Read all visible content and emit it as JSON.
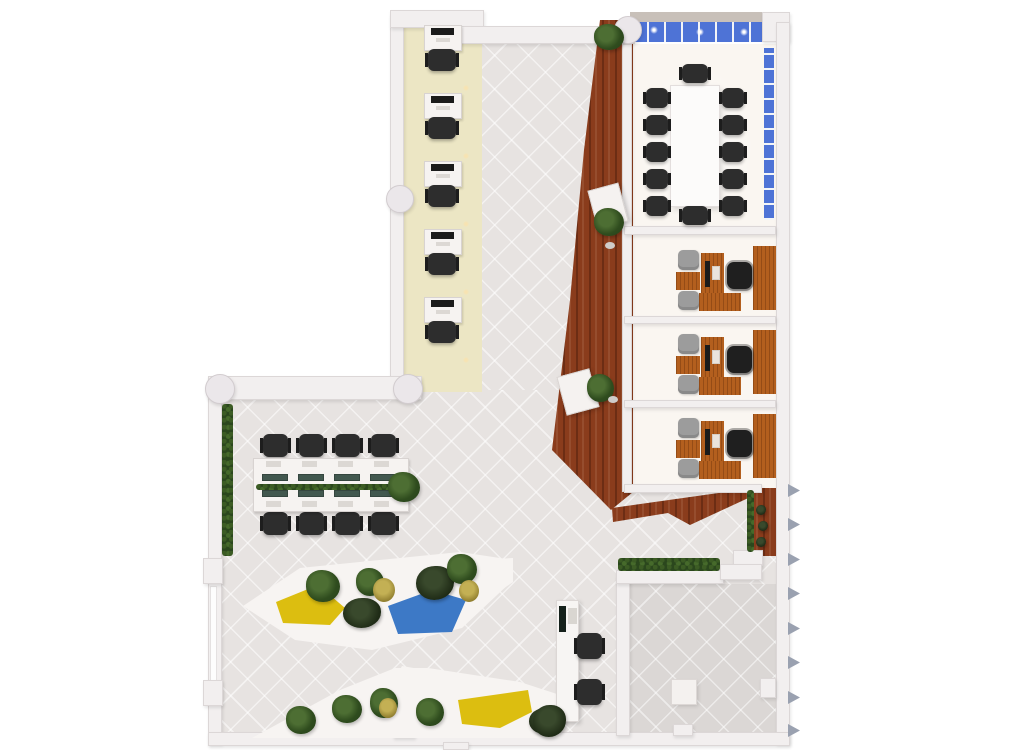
{
  "canvas": {
    "w": 1024,
    "h": 750,
    "background": "#ffffff"
  },
  "palette": {
    "floor_tile": "#e7e3e1",
    "patio_tile": "#dbd7d5",
    "cream_strip": "#ece6c4",
    "room_floor": "#faf6f1",
    "walkway_wood": "#8a3c1c",
    "desk_wood": "#b35f1e",
    "window_blue": "#4e73d6",
    "wall": "#f2efef",
    "facade_band": "#c8c0b9",
    "hedge_green": "#2b471d",
    "seat_yellow": "#dcbe10",
    "seat_blue": "#3d79c6",
    "chair_black": "#2d2d2d",
    "chair_gray": "#9c9c9c",
    "monitor_teal": "#42584f"
  },
  "scene": {
    "base": [
      {
        "n": "floor-open-area",
        "t": "tile",
        "x": 210,
        "y": 376,
        "w": 580,
        "h": 368
      },
      {
        "n": "floor-upper-hall",
        "t": "tile",
        "x": 455,
        "y": 26,
        "w": 180,
        "h": 364
      },
      {
        "n": "floor-corridor-cream",
        "t": "cream",
        "x": 404,
        "y": 14,
        "w": 78,
        "h": 378
      },
      {
        "n": "floor-rooms",
        "t": "room",
        "x": 630,
        "y": 44,
        "w": 146,
        "h": 446
      },
      {
        "n": "floor-patio",
        "t": "tileD",
        "x": 628,
        "y": 584,
        "w": 148,
        "h": 150
      },
      {
        "n": "wood-walkway",
        "t": "wood",
        "x": 550,
        "y": 18,
        "w": 86,
        "h": 494,
        "clip": "50px 2px,83px 2px,83px 474px,61px 492px,2px 432px,20px 282px,34px 132px"
      },
      {
        "n": "wood-chevron-bench",
        "t": "wood",
        "x": 610,
        "y": 486,
        "w": 150,
        "h": 40,
        "clip": "2px 22px,137px 3px,147px 8px,80px 39px,58px 27px,3px 36px"
      },
      {
        "n": "wood-strip-right",
        "t": "wood",
        "x": 750,
        "y": 488,
        "w": 28,
        "h": 68
      },
      {
        "n": "conference-floor-glow",
        "t": "glow",
        "x": 640,
        "y": 66,
        "w": 112,
        "h": 160
      },
      {
        "n": "wall-corridor-left",
        "t": "wall",
        "x": 390,
        "y": 14,
        "w": 14,
        "h": 380
      },
      {
        "n": "wall-corridor-cap",
        "t": "wall",
        "x": 390,
        "y": 10,
        "w": 94,
        "h": 18
      },
      {
        "n": "wall-top-mid",
        "t": "wall",
        "x": 455,
        "y": 26,
        "w": 178,
        "h": 18
      },
      {
        "n": "facade-band-top",
        "t": "beige",
        "x": 630,
        "y": 12,
        "w": 158,
        "h": 12
      },
      {
        "n": "window-band-top",
        "t": "winH",
        "x": 630,
        "y": 22,
        "w": 134,
        "h": 20
      },
      {
        "n": "wall-corner-topright",
        "t": "wall",
        "x": 762,
        "y": 12,
        "w": 28,
        "h": 30
      },
      {
        "n": "wall-right",
        "t": "wall",
        "x": 776,
        "y": 22,
        "w": 14,
        "h": 722
      },
      {
        "n": "window-band-right",
        "t": "winV",
        "x": 764,
        "y": 48,
        "w": 10,
        "h": 172
      },
      {
        "n": "wall-rooms-left",
        "t": "wall",
        "x": 622,
        "y": 44,
        "w": 10,
        "h": 448
      },
      {
        "n": "wall-conference-bottom",
        "t": "wall",
        "x": 624,
        "y": 226,
        "w": 152,
        "h": 9
      },
      {
        "n": "wall-office-divider-1",
        "t": "wall",
        "x": 624,
        "y": 316,
        "w": 152,
        "h": 8
      },
      {
        "n": "wall-office-divider-2",
        "t": "wall",
        "x": 624,
        "y": 400,
        "w": 152,
        "h": 8
      },
      {
        "n": "wall-offices-bottom",
        "t": "wall",
        "x": 624,
        "y": 484,
        "w": 138,
        "h": 9
      },
      {
        "n": "wall-mid-horizontal",
        "t": "wall",
        "x": 208,
        "y": 376,
        "w": 214,
        "h": 24
      },
      {
        "n": "wall-left",
        "t": "wall",
        "x": 208,
        "y": 376,
        "w": 14,
        "h": 368
      },
      {
        "n": "glazing-left-wall",
        "t": "glz",
        "x": 210,
        "y": 586,
        "w": 7,
        "h": 98
      },
      {
        "n": "wall-bottom",
        "t": "wall",
        "x": 208,
        "y": 732,
        "w": 582,
        "h": 14
      },
      {
        "n": "ledge-wood-strip",
        "t": "wall",
        "x": 733,
        "y": 550,
        "w": 30,
        "h": 16
      },
      {
        "n": "wall-patio-left",
        "t": "wall",
        "x": 616,
        "y": 576,
        "w": 14,
        "h": 160
      },
      {
        "n": "wall-patio-top",
        "t": "wall",
        "x": 616,
        "y": 570,
        "w": 108,
        "h": 14
      },
      {
        "n": "wall-patio-ledge",
        "t": "wall",
        "x": 720,
        "y": 564,
        "w": 42,
        "h": 16
      },
      {
        "n": "column-left-wall-1",
        "t": "wall",
        "x": 203,
        "y": 558,
        "w": 20,
        "h": 26
      },
      {
        "n": "column-left-wall-2",
        "t": "wall",
        "x": 203,
        "y": 680,
        "w": 20,
        "h": 26
      },
      {
        "n": "stub-bottom-wall",
        "t": "wall",
        "x": 393,
        "y": 726,
        "w": 22,
        "h": 12
      },
      {
        "n": "stub-bottom-exterior",
        "t": "wall",
        "x": 443,
        "y": 742,
        "w": 26,
        "h": 8
      },
      {
        "n": "stub-patio-bottom",
        "t": "wall",
        "x": 673,
        "y": 724,
        "w": 20,
        "h": 12
      },
      {
        "n": "stub-patio-right",
        "t": "wall",
        "x": 760,
        "y": 678,
        "w": 16,
        "h": 20
      },
      {
        "n": "column-round-corridor",
        "t": "colR",
        "x": 386,
        "y": 185,
        "w": 28,
        "h": 28
      },
      {
        "n": "column-round-midwall-left",
        "t": "colR",
        "x": 205,
        "y": 374,
        "w": 30,
        "h": 30
      },
      {
        "n": "column-round-midwall-right",
        "t": "colR",
        "x": 393,
        "y": 374,
        "w": 30,
        "h": 30
      },
      {
        "n": "column-round-top",
        "t": "colR",
        "x": 614,
        "y": 16,
        "w": 28,
        "h": 28
      },
      {
        "n": "window-light-1",
        "t": "dot",
        "x": 650,
        "y": 26,
        "w": 8,
        "h": 8
      },
      {
        "n": "window-light-2",
        "t": "dot",
        "x": 696,
        "y": 28,
        "w": 8,
        "h": 8
      },
      {
        "n": "window-light-3",
        "t": "dot",
        "x": 740,
        "y": 28,
        "w": 8,
        "h": 8
      }
    ],
    "corridor_workstations": {
      "ys": [
        25,
        93,
        161,
        229,
        297
      ],
      "desk": {
        "x": 424,
        "w": 38,
        "h": 26
      },
      "monitor": {
        "dx": 7,
        "dy": 3,
        "w": 23,
        "h": 7
      },
      "keyboard": {
        "dx": 12,
        "dy": 13,
        "w": 14,
        "h": 4
      },
      "chair": {
        "x": 428,
        "dy": 24,
        "w": 28,
        "h": 22
      },
      "light": {
        "x": 463,
        "dy": 60,
        "s": 6
      }
    },
    "conference": {
      "table": {
        "x": 671,
        "y": 86,
        "w": 48,
        "h": 120
      },
      "side_chair_ys": [
        88,
        115,
        142,
        169,
        196
      ],
      "left_x": 646,
      "right_x": 722,
      "chair_w": 22,
      "chair_h": 20,
      "top_chair": {
        "x": 682,
        "y": 64,
        "w": 26,
        "h": 19
      },
      "bottom_chair": {
        "x": 682,
        "y": 206,
        "w": 26,
        "h": 19
      }
    },
    "offices": {
      "tops": [
        240,
        324,
        408
      ],
      "parts": [
        {
          "n": "office-credenza",
          "t": "woodD",
          "dx": 753,
          "dy": 6,
          "w": 23,
          "h": 64
        },
        {
          "n": "guest-chair",
          "t": "chairG",
          "dx": 678,
          "dy": 10,
          "w": 21,
          "h": 20
        },
        {
          "n": "coffee-table",
          "t": "woodD",
          "dx": 676,
          "dy": 32,
          "w": 24,
          "h": 18
        },
        {
          "n": "guest-chair",
          "t": "chairG",
          "dx": 678,
          "dy": 51,
          "w": 21,
          "h": 19
        },
        {
          "n": "office-desk",
          "t": "woodD",
          "dx": 701,
          "dy": 13,
          "w": 23,
          "h": 58
        },
        {
          "n": "office-desk-return",
          "t": "woodD",
          "dx": 699,
          "dy": 53,
          "w": 42,
          "h": 18
        },
        {
          "n": "desk-monitor",
          "t": "monD",
          "dx": 705,
          "dy": 21,
          "w": 5,
          "h": 26
        },
        {
          "n": "desk-keyboard",
          "t": "key",
          "dx": 712,
          "dy": 26,
          "w": 8,
          "h": 14
        },
        {
          "n": "exec-chair",
          "t": "chairE",
          "dx": 727,
          "dy": 22,
          "w": 25,
          "h": 27
        }
      ]
    },
    "bench": {
      "desk": {
        "x": 253,
        "y": 458,
        "w": 156,
        "h": 54
      },
      "monitor_xs": [
        262,
        298,
        334,
        370
      ],
      "monitor_rows": [
        474,
        490
      ],
      "monitor": {
        "w": 26,
        "h": 7
      },
      "chair_xs": [
        263,
        299,
        335,
        371
      ],
      "chair_rows": [
        434,
        512
      ],
      "chair": {
        "w": 25,
        "h": 23
      },
      "paper_xs": [
        266,
        302,
        338,
        374
      ],
      "paper_rows": [
        461,
        501
      ],
      "paper": {
        "w": 15,
        "h": 6
      },
      "divider": {
        "x": 256,
        "y": 484,
        "w": 136,
        "h": 6
      },
      "end_plant": {
        "x": 388,
        "y": 472,
        "w": 32,
        "h": 30
      }
    },
    "fins": {
      "x": 788,
      "w": 12,
      "h": 13,
      "ys": [
        484,
        518,
        553,
        587,
        622,
        656,
        691,
        724
      ]
    },
    "post": [
      {
        "n": "walkway-plant-top",
        "t": "plant",
        "x": 594,
        "y": 24,
        "w": 30,
        "h": 26
      },
      {
        "n": "lectern-upper",
        "t": "lect",
        "x": 592,
        "y": 186,
        "w": 32,
        "h": 40,
        "r": -15
      },
      {
        "n": "lectern-upper-plant",
        "t": "plant",
        "x": 594,
        "y": 208,
        "w": 30,
        "h": 28
      },
      {
        "n": "lectern-upper-stool",
        "t": "pebble",
        "x": 605,
        "y": 242,
        "w": 10,
        "h": 7
      },
      {
        "n": "lectern-lower",
        "t": "lect",
        "x": 561,
        "y": 372,
        "w": 34,
        "h": 40,
        "r": -15
      },
      {
        "n": "lectern-lower-plant",
        "t": "plant",
        "x": 587,
        "y": 374,
        "w": 27,
        "h": 28
      },
      {
        "n": "lectern-lower-stool",
        "t": "pebble",
        "x": 608,
        "y": 396,
        "w": 10,
        "h": 7
      },
      {
        "n": "hedge-left-wall",
        "t": "hedge",
        "x": 222,
        "y": 404,
        "w": 11,
        "h": 152
      },
      {
        "n": "hedge-wood-strip",
        "t": "hedge",
        "x": 747,
        "y": 490,
        "w": 7,
        "h": 62
      },
      {
        "n": "planter-pot-1",
        "t": "plantD",
        "x": 756,
        "y": 505,
        "w": 10,
        "h": 10
      },
      {
        "n": "planter-pot-2",
        "t": "plantD",
        "x": 758,
        "y": 521,
        "w": 10,
        "h": 10
      },
      {
        "n": "planter-pot-3",
        "t": "plantD",
        "x": 756,
        "y": 537,
        "w": 10,
        "h": 10
      },
      {
        "n": "hedge-patio-top",
        "t": "hedge",
        "x": 618,
        "y": 558,
        "w": 102,
        "h": 13
      },
      {
        "n": "lounge1-base",
        "t": "poly",
        "x": 240,
        "y": 552,
        "w": 275,
        "h": 100,
        "clip": "3px 54px,60px 16px,220px 0px,273px 8px,273px 28px,222px 76px,132px 98px,55px 88px"
      },
      {
        "n": "lounge1-wedge-mid",
        "t": "poly",
        "x": 352,
        "y": 576,
        "w": 46,
        "h": 36,
        "clip": "3px 24px,26px 2px,44px 6px,36px 34px,10px 36px"
      },
      {
        "n": "lounge1-wedge-right",
        "t": "poly",
        "x": 455,
        "y": 552,
        "w": 60,
        "h": 60,
        "clip": "3px 48px,25px 8px,58px 6px,58px 30px,15px 60px"
      },
      {
        "n": "lounge1-seat-yellow",
        "t": "seatY",
        "x": 270,
        "y": 585,
        "w": 80,
        "h": 42,
        "clip": "6px 17px,48px 0px,75px 23px,60px 40px,13px 38px"
      },
      {
        "n": "lounge1-seat-blue",
        "t": "seatB",
        "x": 380,
        "y": 590,
        "w": 88,
        "h": 46,
        "clip": "8px 16px,52px 0px,86px 10px,72px 42px,18px 44px"
      },
      {
        "n": "lounge1-plant-1",
        "t": "plant",
        "x": 306,
        "y": 570,
        "w": 34,
        "h": 32
      },
      {
        "n": "lounge1-plant-2",
        "t": "plantD",
        "x": 343,
        "y": 598,
        "w": 38,
        "h": 30
      },
      {
        "n": "lounge1-plant-3",
        "t": "plant",
        "x": 356,
        "y": 568,
        "w": 28,
        "h": 28
      },
      {
        "n": "lounge1-plant-4",
        "t": "plantG",
        "x": 373,
        "y": 578,
        "w": 22,
        "h": 24
      },
      {
        "n": "lounge1-plant-5",
        "t": "plantD",
        "x": 416,
        "y": 566,
        "w": 38,
        "h": 34
      },
      {
        "n": "lounge1-plant-6",
        "t": "plant",
        "x": 447,
        "y": 554,
        "w": 30,
        "h": 30
      },
      {
        "n": "lounge1-plant-7",
        "t": "plantG",
        "x": 459,
        "y": 580,
        "w": 20,
        "h": 22
      },
      {
        "n": "lounge2-base",
        "t": "poly",
        "x": 250,
        "y": 665,
        "w": 315,
        "h": 75,
        "clip": "2px 73px,90px 25px,145px 3px,178px 3px,270px 17px,310px 30px,310px 73px"
      },
      {
        "n": "lounge2-wedge",
        "t": "poly",
        "x": 380,
        "y": 665,
        "w": 45,
        "h": 38,
        "clip": "3px 35px,22px 1px,45px 5px,38px 37px"
      },
      {
        "n": "lounge2-seat-yellow",
        "t": "seatY",
        "x": 450,
        "y": 690,
        "w": 82,
        "h": 38,
        "clip": "8px 10px,78px 0px,82px 22px,50px 38px,12px 34px"
      },
      {
        "n": "lounge2-plant-1",
        "t": "plant",
        "x": 286,
        "y": 706,
        "w": 30,
        "h": 28
      },
      {
        "n": "lounge2-plant-2",
        "t": "plant",
        "x": 332,
        "y": 695,
        "w": 30,
        "h": 28
      },
      {
        "n": "lounge2-plant-3",
        "t": "plant",
        "x": 370,
        "y": 688,
        "w": 28,
        "h": 30
      },
      {
        "n": "lounge2-plant-4",
        "t": "plantG",
        "x": 379,
        "y": 698,
        "w": 18,
        "h": 20
      },
      {
        "n": "lounge2-plant-5",
        "t": "plant",
        "x": 416,
        "y": 698,
        "w": 28,
        "h": 28
      },
      {
        "n": "lounge2-plant-6",
        "t": "plantD",
        "x": 529,
        "y": 708,
        "w": 32,
        "h": 26
      },
      {
        "n": "reception-cabinet",
        "t": "cab",
        "x": 556,
        "y": 600,
        "w": 23,
        "h": 122
      },
      {
        "n": "reception-screen",
        "t": "screen",
        "x": 559,
        "y": 606,
        "w": 7,
        "h": 26
      },
      {
        "n": "reception-tray",
        "t": "strip",
        "x": 568,
        "y": 608,
        "w": 9,
        "h": 16
      },
      {
        "n": "reception-chair-1",
        "t": "chairB",
        "x": 577,
        "y": 633,
        "w": 25,
        "h": 26
      },
      {
        "n": "reception-chair-2",
        "t": "chairB",
        "x": 577,
        "y": 679,
        "w": 25,
        "h": 26
      },
      {
        "n": "reception-plant",
        "t": "plantD",
        "x": 533,
        "y": 705,
        "w": 33,
        "h": 32
      },
      {
        "n": "patio-square",
        "t": "sq",
        "x": 672,
        "y": 680,
        "w": 24,
        "h": 24
      }
    ]
  }
}
